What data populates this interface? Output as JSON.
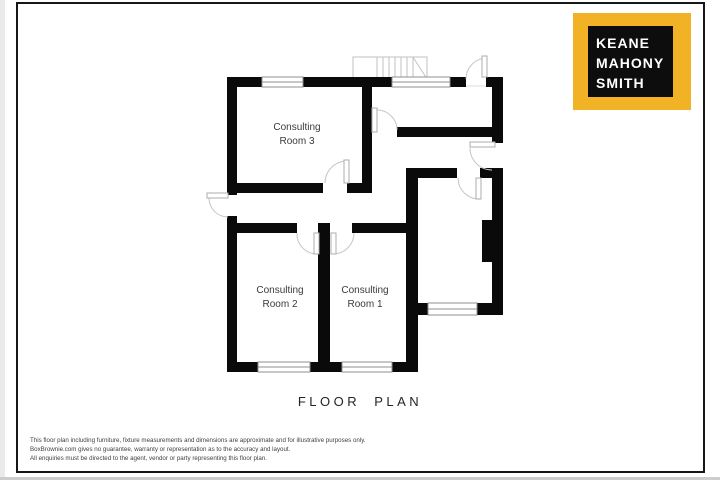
{
  "page": {
    "title_label": "FLOOR PLAN"
  },
  "logo": {
    "line1": "KEANE",
    "line2": "MAHONY",
    "line3": "SMITH",
    "background": "#F1B226",
    "panel": "#0D0D0D",
    "text_color": "#FFFFFF"
  },
  "plan": {
    "wall_color": "#0A0A0A",
    "rooms": [
      {
        "id": "consulting-room-3",
        "label_line1": "Consulting",
        "label_line2": "Room 3"
      },
      {
        "id": "consulting-room-2",
        "label_line1": "Consulting",
        "label_line2": "Room 2"
      },
      {
        "id": "consulting-room-1",
        "label_line1": "Consulting",
        "label_line2": "Room 1"
      }
    ]
  },
  "disclaimer": {
    "line1": "This floor plan including furniture, fixture measurements and dimensions are approximate and for illustrative purposes only.",
    "line2": "BoxBrownie.com gives no guarantee, warranty or representation as to the accuracy and layout.",
    "line3": "All enquiries must be directed to the agent, vendor or party representing this floor plan."
  }
}
